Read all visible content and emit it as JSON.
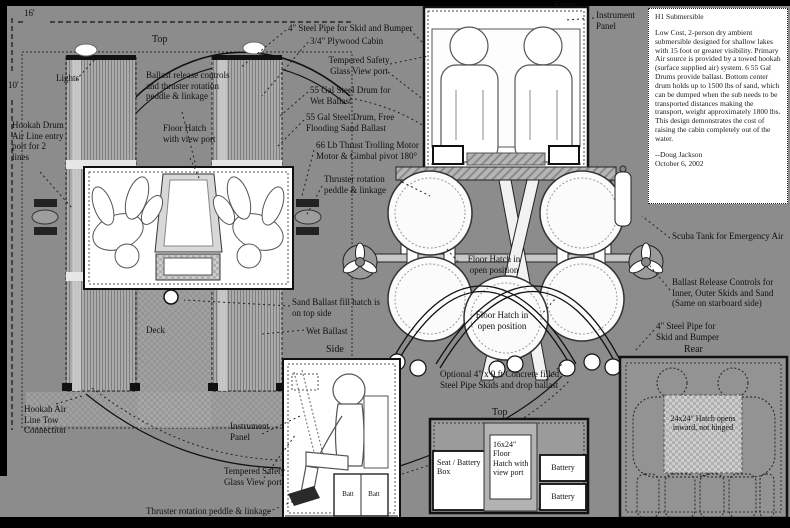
{
  "colors": {
    "background": "#8c8c8c",
    "ink": "#111111",
    "paper": "#ffffff"
  },
  "view_titles": {
    "top": "Top",
    "front": "Front",
    "side": "Side",
    "rear": "Rear",
    "top_interior": "Top"
  },
  "dimensions": {
    "beam": "16'",
    "length": "10'"
  },
  "annotations": {
    "lights": "Lights",
    "hookah_entry": "Hookah Drum Air Line entry port for 2 lines",
    "ballast_controls": "Ballast release controls and thruster rotation peddle & linkage",
    "floor_hatch_viewport": "Floor Hatch with view port",
    "steel_pipe_front": "4\" Steel Pipe for Skid and Bumper",
    "plywood_cabin": "3/4\" Plywood Cabin",
    "tempered_glass": "Tempered Safety Glass View port",
    "drum_wet": "55 Gal Steel Drum for Wet Ballast",
    "drum_sand": "55 Gal Steel Drum, Free Flooding Sand Ballast",
    "trolling_motor": "66 Lb Thrust Trolling Motor\nMotor & Gimbal pivot 180°",
    "thruster_rotation": "Thruster rotation peddle & linkage",
    "instrument_panel": "Instrument Panel",
    "scuba_tank": "Scuba Tank for Emergency Air",
    "ballast_release_rear": "Ballast Release Controls for\nInner, Outer Skids and Sand\n(Same on starboard side)",
    "steel_pipe_rear": "4\" Steel Pipe for\nSkid and Bumper",
    "floor_hatch_open": "Floor Hatch in open position",
    "sand_fill": "Sand Ballast fill hatch is on top side",
    "wet_ballast": "Wet Ballast",
    "deck": "Deck",
    "hookah_tow": "Hookah Air Line Tow Connection",
    "optional_skids": "Optional 4\" x 9 ft Concrete filled Steel Pipe Skids and drop ballast",
    "floor_hatch_16": "16x24\" Floor Hatch with view port",
    "battery": "Battery",
    "seat_battery_box": "Seat / Battery Box",
    "batt": "Batt",
    "hatch_24": "24x24\" Hatch opens inward, not hinged"
  },
  "info_box": {
    "title": "H1 Submersible",
    "body": "Low Cost, 2-person dry ambient submersible designed for shallow lakes with 15 foot or greater visibility. Primary Air source is provided by a towed hookah  (surface supplied air) system.  6 55 Gal Drums provide ballast. Bottom center drum holds up to 1500 lbs of sand, which can be dumped when the sub needs to be transported distances making the transport, weight approximately 1800 lbs.  This design demonstrates the cost of raising the cabin completely out of the water.",
    "signature": "--Doug Jackson",
    "date": "October 6, 2002"
  }
}
